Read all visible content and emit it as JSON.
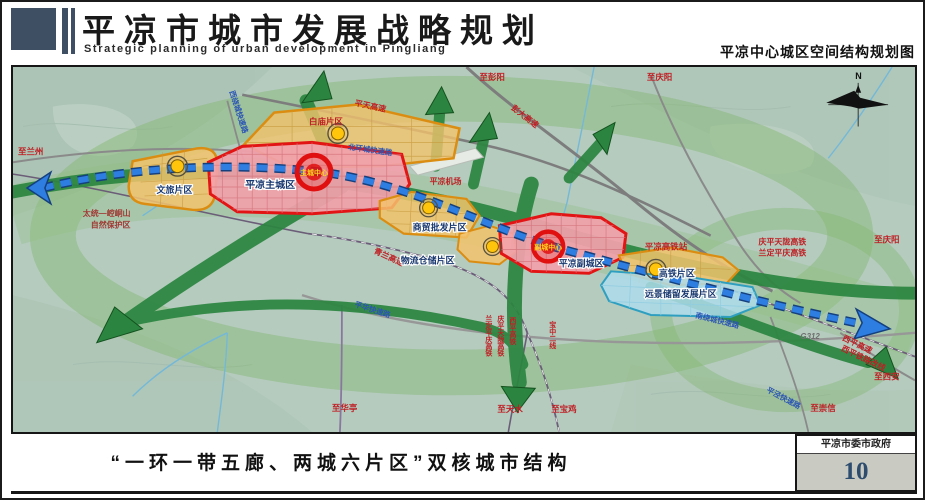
{
  "header": {
    "title": "平凉市城市发展战略规划",
    "subtitle": "Strategic planning of urban development in Pingliang",
    "map_name": "平凉中心城区空间结构规划图"
  },
  "footer": {
    "caption": "“一环一带五廊、两城六片区”双核城市结构",
    "organization": "平凉市委市政府",
    "page_number": "10"
  },
  "map": {
    "compass_n": "N",
    "districts": {
      "wenlv": "文旅片区",
      "baimiao": "白庙片区",
      "main_city": "平凉主城区",
      "shangmao": "商贸批发片区",
      "wuliu": "物流仓储片区",
      "fucheng": "平凉副城区",
      "gaotie": "高铁片区",
      "yuanjing": "远景储留发展片区"
    },
    "centers": {
      "main": "主城中心",
      "sub": "副城中心"
    },
    "roads": {
      "pengda": "彭大高速",
      "pingtian": "平天高速",
      "qinglan": "青兰高速",
      "xirao": "西绕城快速路",
      "beihuan": "北环城快速路",
      "nanrao": "南绕城快速路",
      "pinghua": "平华快速路",
      "pingjing": "平泾快速路",
      "g312": "G312",
      "xiping_expwy": "西平高速",
      "xiping_reroute": "西平铁路改线"
    },
    "rails": {
      "qingping_tianlong": "庆平天陇高铁",
      "landing_pingqing": "兰定平庆高铁",
      "xiping_hsr": "西平高铁",
      "baozhong2": "宝中二线",
      "station": "平凉高铁站"
    },
    "directions": {
      "lanzhou": "至兰州",
      "pengyang": "至彭阳",
      "qingyang_top": "至庆阳",
      "qingyang_right": "至庆阳",
      "xian": "至西安",
      "chongxin": "至崇信",
      "huating": "至华亭",
      "tianshui": "至天水",
      "baoji": "至宝鸡"
    },
    "nature_reserve": {
      "line1": "太统—崆峒山",
      "line2": "自然保护区"
    },
    "airport": "平凉机场"
  }
}
